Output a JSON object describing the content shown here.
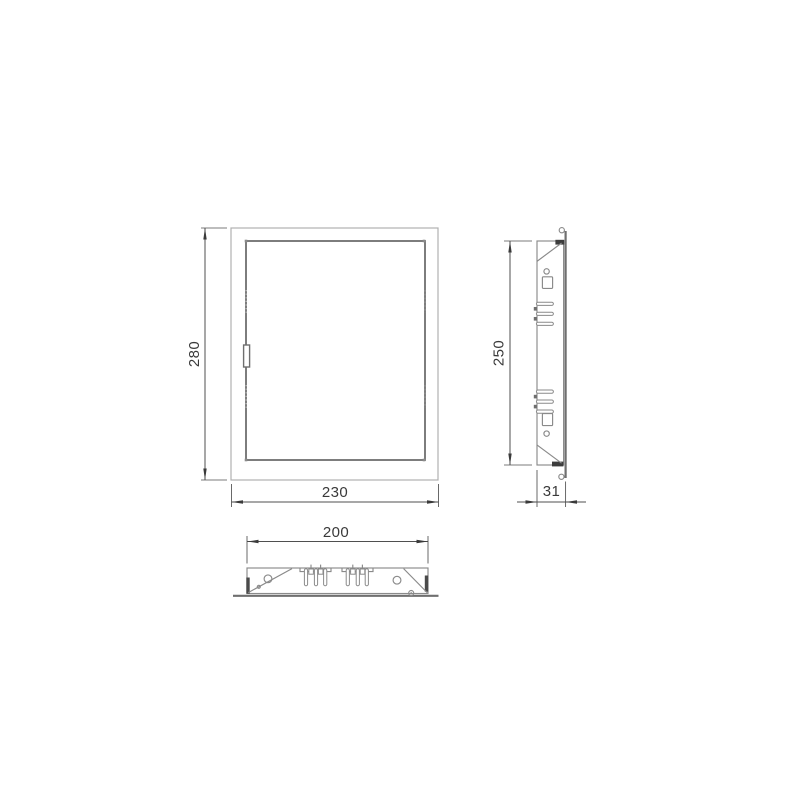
{
  "drawing": {
    "front_view": {
      "height_label": "280",
      "width_label": "230"
    },
    "side_view": {
      "height_label": "250",
      "depth_label": "31"
    },
    "bottom_view": {
      "width_label": "200"
    }
  },
  "colors": {
    "background": "#ffffff",
    "outline_light": "#b0b0b0",
    "outline": "#8a8a8a",
    "object_dark": "#6f6f6f",
    "section_fill": "#3c3c3c",
    "dimension_line": "#4f4f4f",
    "label_text": "#3a3a3a"
  }
}
